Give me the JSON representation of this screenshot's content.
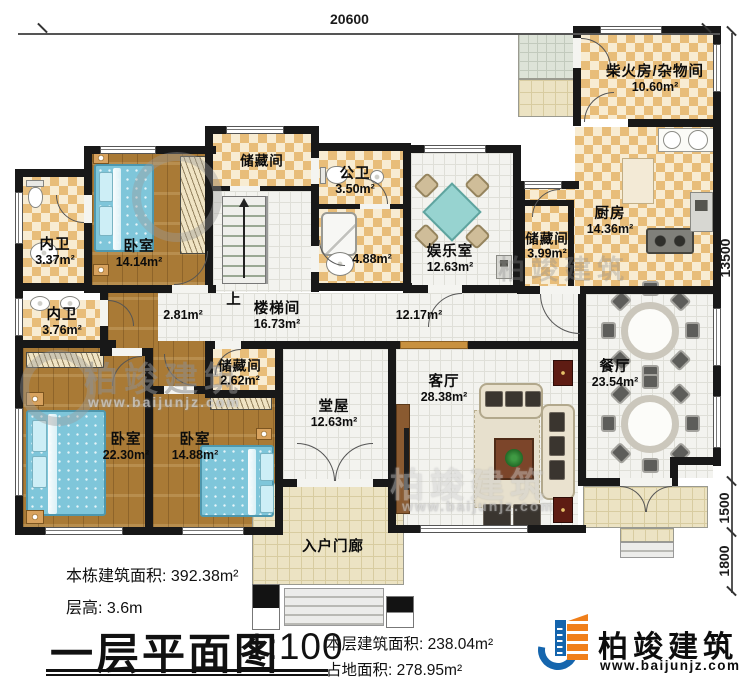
{
  "dimensions": {
    "top_width": "20600",
    "right_height_total": "13500",
    "right_height_mid": "1500",
    "right_height_bottom": "1800"
  },
  "rooms": {
    "neiwei_1": {
      "name": "内卫",
      "area": "3.37m²"
    },
    "woshi_1": {
      "name": "卧室",
      "area": "14.14m²"
    },
    "chucang_top": {
      "name": "储藏间"
    },
    "gongwei": {
      "name": "公卫",
      "area": "3.50m²"
    },
    "xiyushi": {
      "area": "4.88m²"
    },
    "yuleshi": {
      "name": "娱乐室",
      "area": "12.63m²"
    },
    "chaihuofang": {
      "name": "柴火房/杂物间",
      "area": "10.60m²"
    },
    "chufang": {
      "name": "厨房",
      "area": "14.36m²"
    },
    "chucang_chufang": {
      "name": "储藏间",
      "area": "3.99m²"
    },
    "canting": {
      "name": "餐厅",
      "area": "23.54m²"
    },
    "loutijian": {
      "name": "楼梯间",
      "area": "16.73m²"
    },
    "guodao_xiao": {
      "area": "2.81m²"
    },
    "guodao": {
      "area": "12.17m²"
    },
    "neiwei_2": {
      "name": "内卫",
      "area": "3.76m²"
    },
    "chucang_2": {
      "name": "储藏间",
      "area": "2.62m²"
    },
    "woshi_2": {
      "name": "卧室",
      "area": "22.30m²"
    },
    "woshi_3": {
      "name": "卧室",
      "area": "14.88m²"
    },
    "tangwu": {
      "name": "堂屋",
      "area": "12.63m²"
    },
    "keting": {
      "name": "客厅",
      "area": "28.38m²"
    },
    "menlang": {
      "name": "入户门廊"
    }
  },
  "stairs": {
    "up_label": "上"
  },
  "title_block": {
    "building_area_label": "本栋建筑面积:",
    "building_area_value": "392.38m²",
    "floor_height_label": "层高:",
    "floor_height_value": "3.6m",
    "plan_title": "一层平面图",
    "scale": "1:100",
    "floor_area_label": "本层建筑面积:",
    "floor_area_value": "238.04m²",
    "footprint_label": "占地面积:",
    "footprint_value": "278.95m²"
  },
  "logo": {
    "brand": "柏竣建筑",
    "website": "www.baijunjz.com"
  },
  "watermark": {
    "brand": "柏竣建筑",
    "website": "www.baijunjz.com"
  },
  "colors": {
    "wall": "#181818",
    "checker": "#e8bd79",
    "wood": "#a97a36",
    "accent_blue": "#1565ad",
    "accent_orange": "#f07f1a"
  }
}
